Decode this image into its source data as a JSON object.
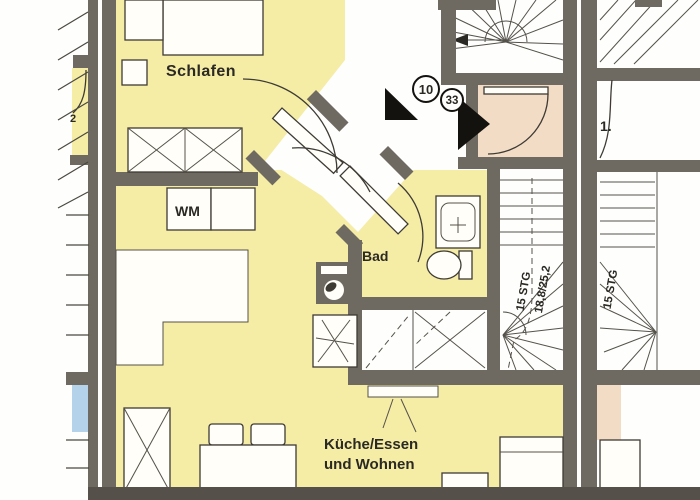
{
  "plan": {
    "rooms": {
      "bedroom_label": "Schlafen",
      "bathroom_label": "Bad",
      "living_label_line1": "Küche/Essen",
      "living_label_line2": "und Wohnen"
    },
    "appliances": {
      "washing_machine_label": "WM"
    },
    "stairs": {
      "flight_label": "15 STG",
      "step_dimensions": "18,8/25,2",
      "neighbor_flight_label": "15 STG"
    },
    "markers": {
      "camera_position_10": "10",
      "camera_position_33": "33"
    },
    "fragments": {
      "right_neighbor_label": "1.",
      "left_neighbor_label": "2"
    },
    "colors": {
      "apartment_floor": "#f5eca6",
      "entry_room": "#f3dcc6",
      "neighbor_room_blue": "#b4d3ea",
      "wall": "#6e6961",
      "base_strip": "#55504a",
      "line": "#3e3b34",
      "text": "#2b2923"
    }
  }
}
